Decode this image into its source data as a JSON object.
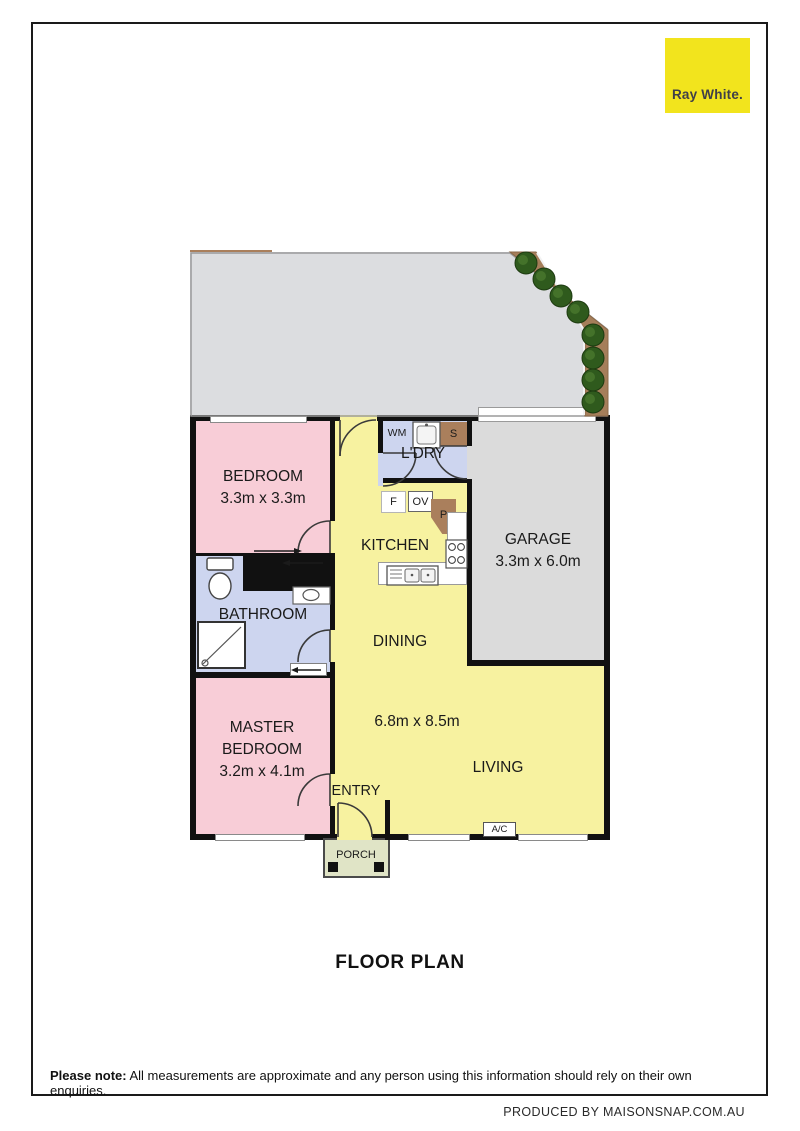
{
  "page": {
    "title": "FLOOR PLAN",
    "credit": "PRODUCED BY MAISONSNAP.COM.AU",
    "disclaimer_bold": "Please note:",
    "disclaimer_text": " All measurements are approximate and any person using this information should rely on their own enquiries."
  },
  "brand": {
    "name": "Ray White.",
    "bg_color": "#F2E41D",
    "text_color": "#3F3F49"
  },
  "rooms": {
    "bedroom": {
      "name": "BEDROOM",
      "dims": "3.3m x 3.3m",
      "color": "#F8CDD7"
    },
    "bathroom": {
      "name": "BATHROOM",
      "color": "#CDD5EF"
    },
    "master_bedroom": {
      "name_line1": "MASTER",
      "name_line2": "BEDROOM",
      "dims": "3.2m x 4.1m",
      "color": "#F8CDD7"
    },
    "laundry": {
      "name": "L'DRY",
      "color": "#CDD5EF"
    },
    "kitchen": {
      "name": "KITCHEN",
      "color": "#F7F2A0"
    },
    "garage": {
      "name": "GARAGE",
      "dims": "3.3m x 6.0m",
      "color": "#DBDBDB"
    },
    "dining": {
      "name": "DINING",
      "color": "#F7F2A0"
    },
    "living": {
      "name": "LIVING",
      "dims": "6.8m x 8.5m",
      "color": "#F7F2A0"
    },
    "entry": {
      "name": "ENTRY"
    },
    "porch": {
      "name": "PORCH",
      "color": "#E0E4C6"
    }
  },
  "fixtures": {
    "washing_machine": "WM",
    "laundry_sink": "S",
    "fridge": "F",
    "oven": "OV",
    "pantry": "P",
    "built_in_robe": "BIR",
    "air_conditioner": "A/C"
  }
}
